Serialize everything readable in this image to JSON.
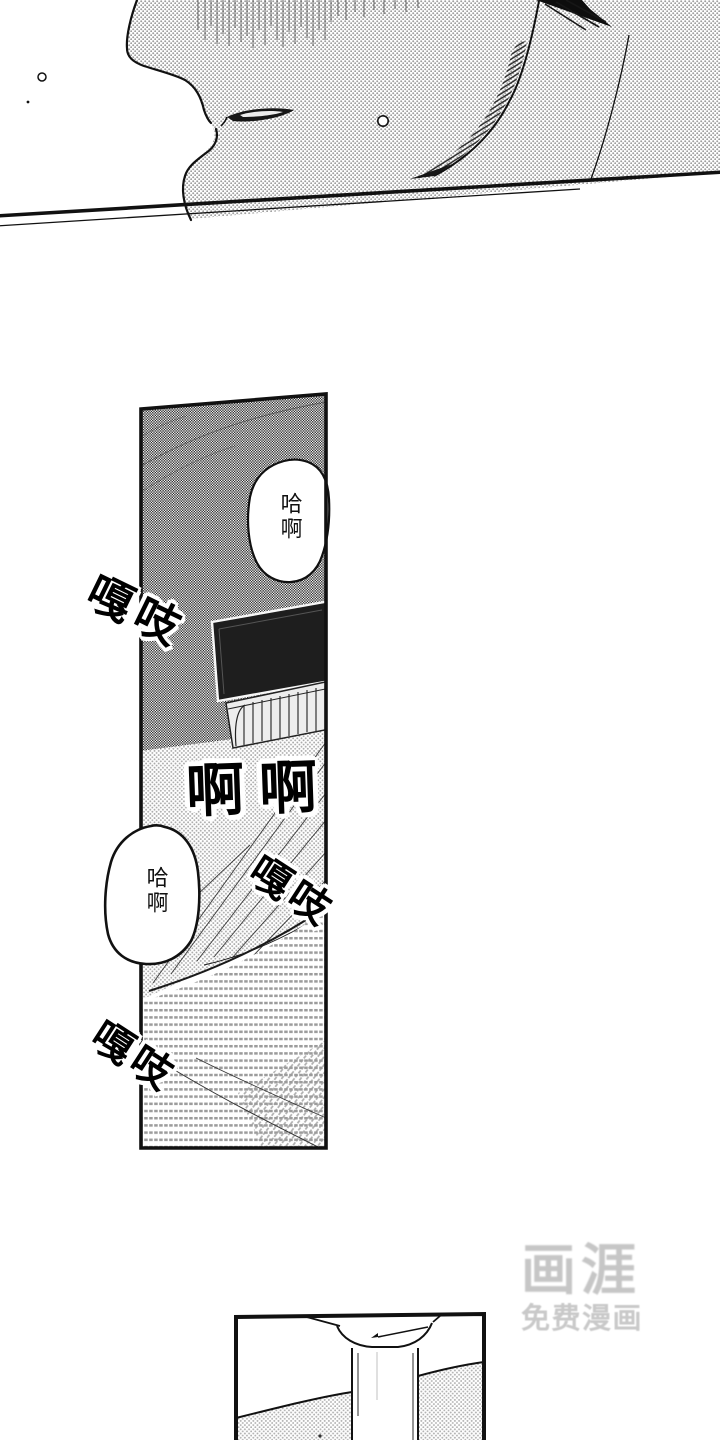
{
  "bubbles": [
    {
      "text": "哈啊"
    },
    {
      "text": "哈啊"
    }
  ],
  "sfx": {
    "creak_top": "嘎吱",
    "moan": "啊啊",
    "creak_right": "嘎吱",
    "creak_bottom": "嘎吱"
  },
  "watermark": {
    "logo": "画涯",
    "tagline": "免费漫画"
  },
  "colors": {
    "ink": "#111111",
    "tone_gray": "#9c9c9c",
    "watermark_gray": "#c6c6c6"
  }
}
